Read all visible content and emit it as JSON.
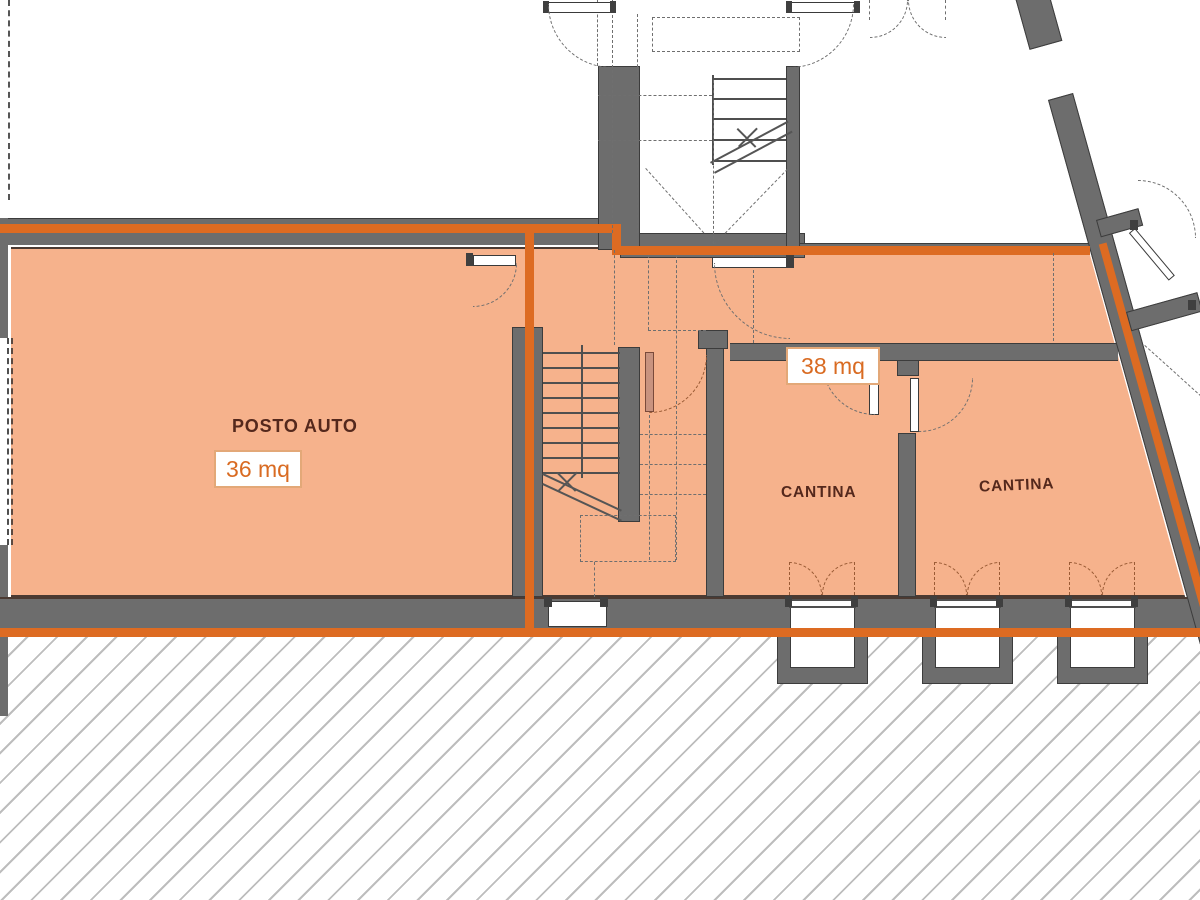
{
  "plan": {
    "title": "basement floor plan",
    "rooms": [
      {
        "id": "posto-auto",
        "label": "POSTO AUTO",
        "area_badge": "36 mq"
      },
      {
        "id": "cantina-1",
        "label": "CANTINA",
        "area_badge": "38 mq"
      },
      {
        "id": "cantina-2",
        "label": "CANTINA"
      }
    ],
    "colors": {
      "floor_fill": "#f6b28c",
      "boundary_orange": "#dd6b22",
      "wall_gray": "#6d6d6d",
      "label_text": "#54281c",
      "badge_text": "#d96b22",
      "badge_border": "#e3a878",
      "hatch_line": "#bdbdbd"
    }
  }
}
